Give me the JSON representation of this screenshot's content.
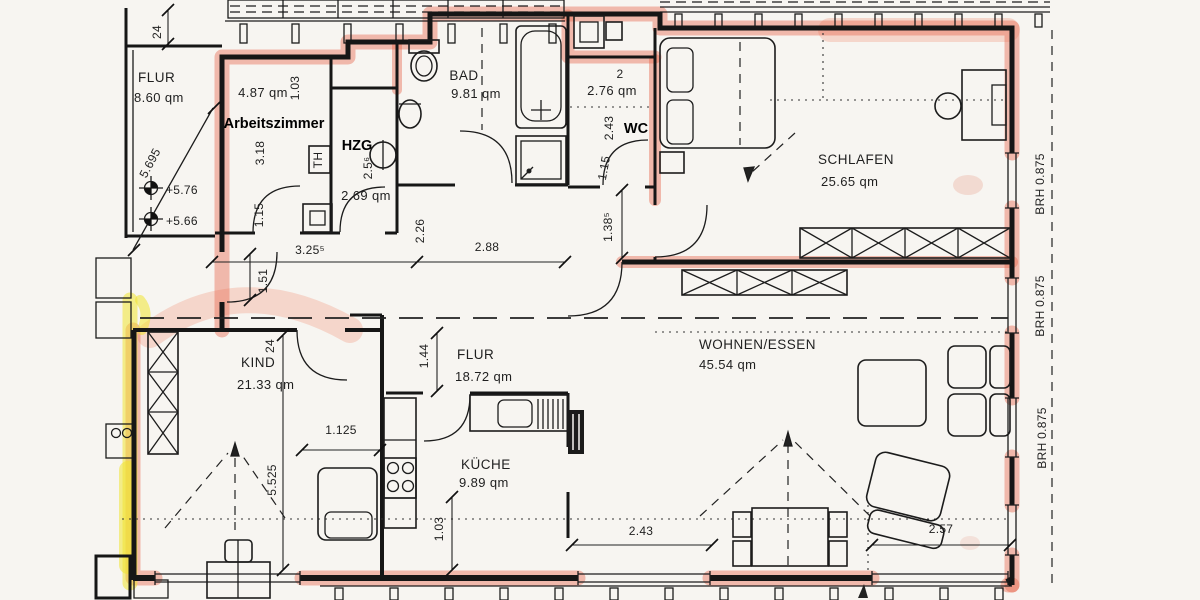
{
  "rooms": {
    "flur_treppenhaus": {
      "name": "FLUR",
      "area": "8.60 qm"
    },
    "arbeitszimmer": {
      "name": "Arbeitszimmer",
      "area": "4.87 qm"
    },
    "hzg": {
      "name": "HZG",
      "area": "2.69 qm"
    },
    "bad": {
      "name": "BAD",
      "area": "9.81 qm"
    },
    "wc": {
      "name": "WC",
      "area": "2.76 qm"
    },
    "schlafen": {
      "name": "SCHLAFEN",
      "area": "25.65 qm"
    },
    "flur": {
      "name": "FLUR",
      "area": "18.72 qm"
    },
    "kind": {
      "name": "KIND",
      "area": "21.33 qm"
    },
    "kueche": {
      "name": "KÜCHE",
      "area": "9.89 qm"
    },
    "wohnen_essen": {
      "name": "WOHNEN/ESSEN",
      "area": "45.54 qm"
    }
  },
  "dims": {
    "treppe_breite": "24",
    "treppe_lauf": "5.695",
    "hoehe_1": "+5.76",
    "hoehe_2": "+5.66",
    "arb_breite": "1.03",
    "arb_tiefe": "3.18",
    "arb_tuer": "1.15",
    "hzg_tiefe": "2.5⁶",
    "wc_tiefe": "2.43",
    "wc_fragment": "2",
    "wc_tuer": "1.15",
    "flur_a": "3.25⁵",
    "flur_b": "2.26",
    "flur_c": "2.88",
    "flur_d": "1.38⁵",
    "flur_e": "1.51",
    "flur_f": "1.44",
    "kind_wand": "24",
    "kind_laenge": "5.525",
    "kind_breite": "1.125",
    "kueche_mass": "1.03",
    "fenster_links": "2.43",
    "fenster_rechts": "2.57",
    "bruestung": "BRH 0.875"
  },
  "symbols": {
    "th_box": "TH"
  }
}
